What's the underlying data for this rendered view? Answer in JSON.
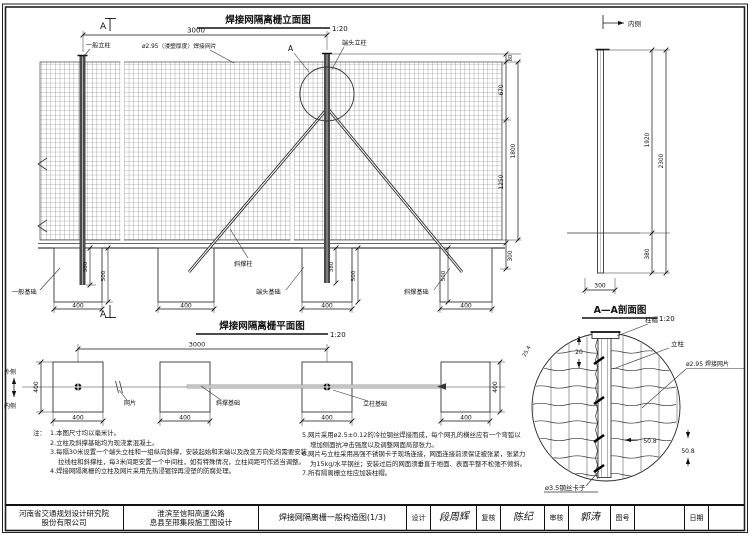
{
  "meta": {
    "scale_label": "1:20"
  },
  "dims": {
    "d3000": "3000",
    "d670": "670",
    "d1250": "1250",
    "d1800": "1800",
    "d80": "80",
    "d300": "300",
    "d1920": "1920",
    "d2300": "2300",
    "d380": "380",
    "d500": "500",
    "d400": "400",
    "d20": "20",
    "d508": "50.8",
    "d254": "25.4"
  },
  "elev": {
    "title": "焊接网隔离栅立面图",
    "section_marker": "A",
    "labels": {
      "general_post": "一般立柱",
      "mesh": "ø2.95（浸塑厚度）焊接网片",
      "end_post": "端头立柱",
      "brace_post": "斜撑柱",
      "general_found": "一般基础",
      "end_found": "端头基础",
      "brace_found": "斜撑基础",
      "inner": "内侧"
    }
  },
  "plan": {
    "title": "焊接网隔离栅平面图",
    "labels": {
      "outer": "外侧",
      "inner": "内侧",
      "mesh": "网片",
      "post_found": "立柱基础",
      "brace_found": "斜撑基础"
    }
  },
  "section": {
    "title": "A—A剖面图",
    "labels": {
      "cap": "柱帽",
      "post": "立柱",
      "mesh": "ø2.95 焊接网片",
      "clip": "ø3.5钢丝卡子"
    }
  },
  "notes": {
    "intro": "注：",
    "left": [
      "1.本图尺寸均以毫米计。",
      "2.立柱及斜撑基础均为现浇素混凝土。",
      "3.每隔30米设置一个端头立柱和一组纵向斜撑，安装起始和末端以及改变方向处均需要安装拉线柱和斜撑柱，每3米间距安置一个中间柱，如有特殊情况，立柱间距可作适当调整。",
      "4.焊接网隔离栅的立柱及网片采用先热浸镀锌再浸塑的防腐处理。"
    ],
    "right": [
      "5.网片采用ø2.5±0.12的冷拉钢丝焊接而成，每个网孔的横丝应有一个弯弧以增加侧面抗冲击强度以及调整网面局部张力。",
      "6.网片与立柱采用高强不锈钢卡子现场连接，网面连接前须保证被张紧，张紧力为15kg/水平钢丝；安装过后的网面须垂直于地面、表面平整不松弛不倾斜。",
      "7.所有隔离栅立柱应加装柱帽。"
    ]
  },
  "tb": {
    "company1": "河南省交通规划设计研究院",
    "company2": "股份有限公司",
    "project1": "淮滨至信阳高速公路",
    "project2": "息县至邢集段施工图设计",
    "sheet": "焊接网隔离栅一般构造图(1/3)",
    "design": "设计",
    "design_sig": "段周辉",
    "check": "复核",
    "check_sig": "陈纪",
    "review": "审核",
    "review_sig": "郭涛",
    "figno": "图号",
    "date": "日期"
  }
}
